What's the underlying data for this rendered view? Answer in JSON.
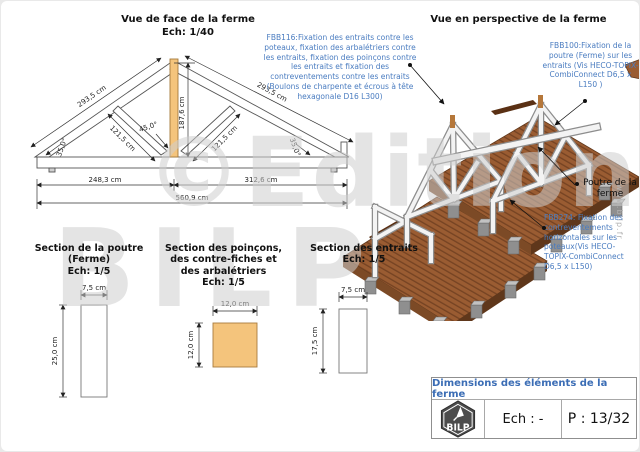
{
  "colors": {
    "annotation_blue": "#4a7cc0",
    "title_block_blue": "#3b6db5",
    "timber_orange": "#f4c47c",
    "deck_brown": "#9a5c32",
    "deck_stripe_brown": "#744222",
    "concrete_gray": "#9a9a9a",
    "watermark_gray": "#cecece"
  },
  "front_view": {
    "title": "Vue de face de la ferme",
    "scale": "Ech: 1/40",
    "dims": {
      "rafter_left": "293,5 cm",
      "rafter_right": "293,5 cm",
      "height": "187,6 cm",
      "brace_left": "121,5 cm",
      "brace_right": "121,5 cm",
      "angle_left": "35,0°",
      "angle_right": "35,0°",
      "angle_apex": "45,0°",
      "span_left": "248,3 cm",
      "span_right": "312,6 cm",
      "span_total": "560,9 cm"
    }
  },
  "perspective_view": {
    "title": "Vue en perspective de la ferme",
    "annotations": {
      "fbb116": "FBB116:Fixation des entraits contre les poteaux, fixation des arbalétriers contre les entraits, fixation des poinçons contre les entraits et fixation des contreventements contre les entraits (Boulons de charpente et écrous à tête hexagonale D16 L300)",
      "fbb100": "FBB100:Fixation de la poutre (Ferme) sur les entraits (Vis HECO-TOPIX-CombiConnect D6,5 x L150 )",
      "fbb274": "FBB274: Fixation des contreventements horizontales sur les poteaux(Vis HECO-TOPIX-CombiConnect D6,5 x L150)",
      "poutre_label": "Poutre de la ferme"
    }
  },
  "sections": {
    "poutre": {
      "title": "Section de la poutre (Ferme)",
      "scale": "Ech: 1/5",
      "width": "7,5 cm",
      "height": "25,0 cm"
    },
    "poincons": {
      "title": "Section des poinçons, des contre-fiches et des arbalétriers",
      "scale": "Ech: 1/5",
      "width": "12,0 cm",
      "height": "12,0 cm"
    },
    "entraits": {
      "title": "Section des entraits",
      "scale": "Ech: 1/5",
      "width": "7,5 cm",
      "height": "17,5 cm"
    }
  },
  "title_block": {
    "title": "Dimensions des éléments de la ferme",
    "logo_text": "BILP",
    "scale_label": "Ech : -",
    "page_label": "P : 13/32"
  },
  "watermark": {
    "line1": "©Editions",
    "line2": "BILP",
    "site": "www.bilp.fr"
  }
}
